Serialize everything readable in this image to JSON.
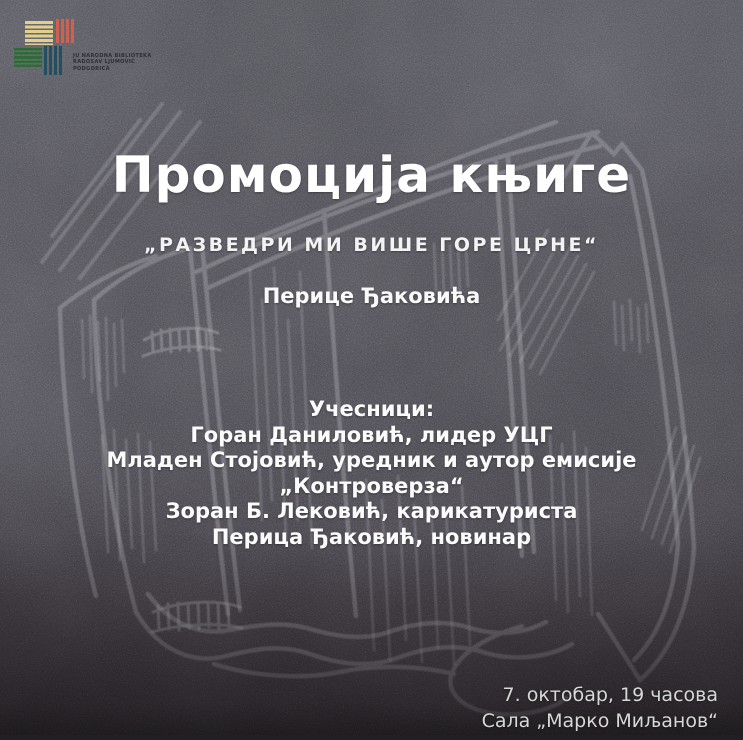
{
  "poster": {
    "logo": {
      "org_lines": [
        "JU NARODNA BIBLIOTEKA",
        "RADOSAV LJUMOVIĆ",
        "PODGORICA"
      ],
      "colors": {
        "yellow": "#e2cf8d",
        "red": "#d2604e",
        "green": "#2f6b38",
        "teal": "#215060"
      }
    },
    "title": "Промоција књиге",
    "book_title": "„РАЗВЕДРИ МИ ВИШЕ ГОРЕ ЦРНЕ“",
    "author": "Перице Ђаковића",
    "participants": {
      "heading": "Учесници:",
      "lines": [
        "Горан Даниловић, лидер УЦГ",
        "Младен Стојовић, уредник и аутор емисије",
        "„Контроверза“",
        "Зоран Б. Лековић, карикатуриста",
        "Перица Ђаковић, новинар"
      ]
    },
    "event": {
      "datetime": "7. октобар, 19 часова",
      "venue": "Сала „Марко Миљанов“"
    },
    "style": {
      "background_color": "#55545c",
      "text_color": "#ffffff",
      "chalk_color": "#c9c9cf",
      "illustration": "chalk drawing of standing books"
    }
  }
}
